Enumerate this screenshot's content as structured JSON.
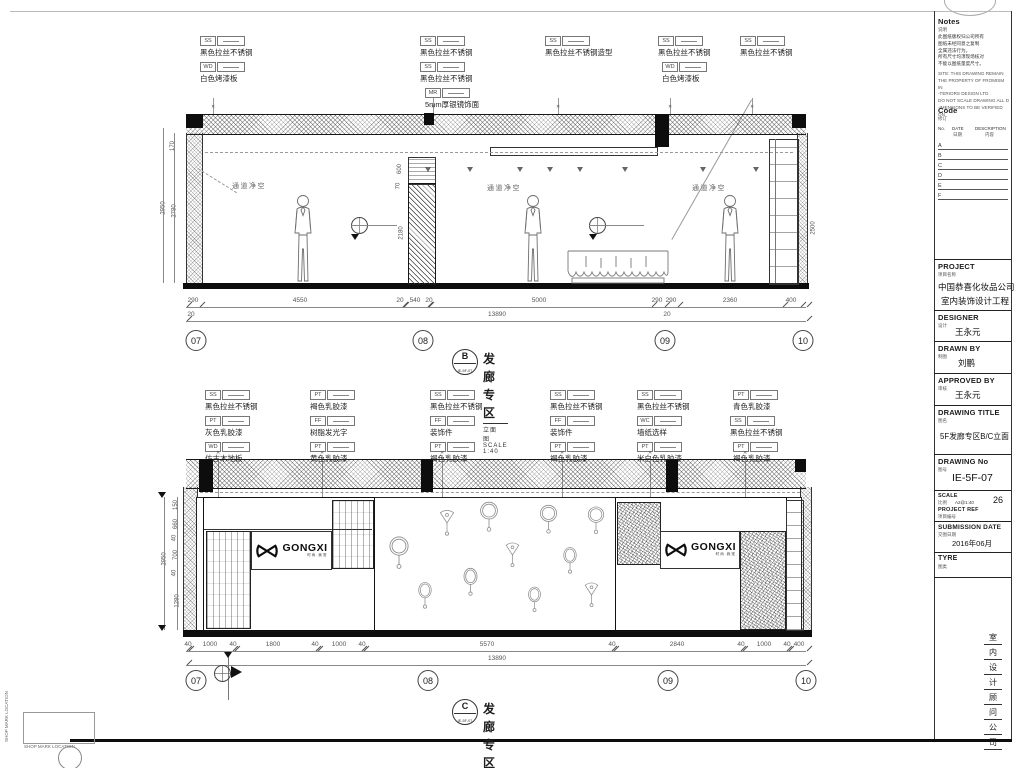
{
  "colors": {
    "ink": "#1c1c1c",
    "dim_gray": "#555555",
    "paper": "#ffffff",
    "hatch": "#3a3a3a"
  },
  "corner": {
    "shop_mark": "SHOP MARK LOCATION"
  },
  "titles": {
    "b": {
      "letter": "B",
      "ref": "IE-5F-07",
      "name": "发廊专区",
      "plan": "立面图",
      "scale": "SCALE 1:40"
    },
    "c": {
      "letter": "C",
      "ref": "IE-5F-07",
      "name": "发廊专区",
      "plan": "立面图",
      "scale": "SCALE 1:40"
    }
  },
  "logo": {
    "text": "GONGXI",
    "tagline": "时尚.我宠"
  },
  "elev_b": {
    "clearance": "通道净空",
    "tags": [
      {
        "x": 200,
        "y": 36,
        "code": "SS",
        "label": "黑色拉丝不锈钢"
      },
      {
        "x": 200,
        "y": 62,
        "code": "WD",
        "label": "白色烤漆板"
      },
      {
        "x": 420,
        "y": 36,
        "code": "SS",
        "label": "黑色拉丝不锈钢"
      },
      {
        "x": 420,
        "y": 62,
        "code": "SS",
        "label": "黑色拉丝不锈钢"
      },
      {
        "x": 425,
        "y": 88,
        "code": "MR",
        "label": "5mm厚银镜饰面"
      },
      {
        "x": 545,
        "y": 36,
        "code": "SS",
        "label": "黑色拉丝不锈钢造型"
      },
      {
        "x": 658,
        "y": 36,
        "code": "SS",
        "label": "黑色拉丝不锈钢"
      },
      {
        "x": 662,
        "y": 62,
        "code": "WD",
        "label": "白色烤漆板"
      },
      {
        "x": 740,
        "y": 36,
        "code": "SS",
        "label": "黑色拉丝不锈钢"
      }
    ],
    "leaders": [
      {
        "x": 213
      },
      {
        "x": 433
      },
      {
        "x": 558
      },
      {
        "x": 670
      },
      {
        "x": 752
      }
    ],
    "lights": [
      {
        "x": 425
      },
      {
        "x": 467
      },
      {
        "x": 517
      },
      {
        "x": 547
      },
      {
        "x": 577
      },
      {
        "x": 622
      },
      {
        "x": 700
      },
      {
        "x": 753
      }
    ],
    "clearances": [
      {
        "x": 232,
        "y": 181
      },
      {
        "x": 487,
        "y": 183
      },
      {
        "x": 692,
        "y": 183
      }
    ],
    "levels": [
      {
        "x": 351,
        "lw": 46
      },
      {
        "x": 589,
        "lw": 55
      }
    ],
    "humans": [
      {
        "x": 286
      },
      {
        "x": 516
      },
      {
        "x": 713
      }
    ],
    "dims1": [
      {
        "v": "290",
        "cx": 193
      },
      {
        "v": "4550",
        "cx": 300
      },
      {
        "v": "20",
        "cx": 400
      },
      {
        "v": "540",
        "cx": 415
      },
      {
        "v": "20",
        "cx": 429
      },
      {
        "v": "5000",
        "cx": 539
      },
      {
        "v": "290",
        "cx": 657
      },
      {
        "v": "290",
        "cx": 671
      },
      {
        "v": "2360",
        "cx": 730
      },
      {
        "v": "400",
        "cx": 791
      }
    ],
    "ticks1": [
      {
        "x": 186
      },
      {
        "x": 199
      },
      {
        "x": 402
      },
      {
        "x": 403
      },
      {
        "x": 427
      },
      {
        "x": 428
      },
      {
        "x": 651
      },
      {
        "x": 664
      },
      {
        "x": 677
      },
      {
        "x": 782
      },
      {
        "x": 800
      },
      {
        "x": 806
      }
    ],
    "dims2": [
      {
        "v": "20",
        "cx": 191
      },
      {
        "v": "13890",
        "cx": 497
      },
      {
        "v": "20",
        "cx": 667
      }
    ],
    "ticks2": [
      {
        "x": 186
      },
      {
        "x": 806
      }
    ],
    "vdims": [
      {
        "v": "2950",
        "x": 157,
        "y": 205
      },
      {
        "v": "2780",
        "x": 168,
        "y": 208
      },
      {
        "v": "170",
        "x": 168,
        "y": 143
      },
      {
        "v": "600",
        "x": 395,
        "y": 166
      },
      {
        "v": "70",
        "x": 395,
        "y": 183
      },
      {
        "v": "2180",
        "x": 395,
        "y": 230
      },
      {
        "v": "2500",
        "x": 807,
        "y": 225
      }
    ],
    "grid": [
      {
        "v": "07",
        "x": 196
      },
      {
        "v": "08",
        "x": 423
      },
      {
        "v": "09",
        "x": 665
      },
      {
        "v": "10",
        "x": 803
      }
    ]
  },
  "elev_c": {
    "tags": [
      {
        "x": 205,
        "y": 390,
        "code": "SS",
        "label": "黑色拉丝不锈钢"
      },
      {
        "x": 205,
        "y": 416,
        "code": "PT",
        "label": "灰色乳胶漆"
      },
      {
        "x": 205,
        "y": 442,
        "code": "WD",
        "label": "仿古木地板"
      },
      {
        "x": 310,
        "y": 390,
        "code": "PT",
        "label": "褐色乳胶漆"
      },
      {
        "x": 310,
        "y": 416,
        "code": "FF",
        "label": "树脂发光字"
      },
      {
        "x": 310,
        "y": 442,
        "code": "PT",
        "label": "黄色乳胶漆"
      },
      {
        "x": 430,
        "y": 390,
        "code": "SS",
        "label": "黑色拉丝不锈钢"
      },
      {
        "x": 430,
        "y": 416,
        "code": "FF",
        "label": "装饰件"
      },
      {
        "x": 430,
        "y": 442,
        "code": "PT",
        "label": "褐色乳胶漆"
      },
      {
        "x": 550,
        "y": 390,
        "code": "SS",
        "label": "黑色拉丝不锈钢"
      },
      {
        "x": 550,
        "y": 416,
        "code": "FF",
        "label": "装饰件"
      },
      {
        "x": 550,
        "y": 442,
        "code": "PT",
        "label": "褐色乳胶漆"
      },
      {
        "x": 637,
        "y": 390,
        "code": "SS",
        "label": "黑色拉丝不锈钢"
      },
      {
        "x": 637,
        "y": 416,
        "code": "WC",
        "label": "墙纸选样"
      },
      {
        "x": 637,
        "y": 442,
        "code": "PT",
        "label": "米白色乳胶漆"
      },
      {
        "x": 733,
        "y": 390,
        "code": "PT",
        "label": "青色乳胶漆"
      },
      {
        "x": 730,
        "y": 416,
        "code": "SS",
        "label": "黑色拉丝不锈钢"
      },
      {
        "x": 733,
        "y": 442,
        "code": "PT",
        "label": "褐色乳胶漆"
      }
    ],
    "leaders": [
      {
        "x": 218,
        "h": 64
      },
      {
        "x": 322,
        "h": 100
      },
      {
        "x": 442,
        "h": 165
      },
      {
        "x": 562,
        "h": 64
      },
      {
        "x": 650,
        "h": 106
      },
      {
        "x": 745,
        "h": 172
      }
    ],
    "mirrors": [
      {
        "x": 386,
        "y": 535,
        "w": 26,
        "h": 36,
        "icon": "#mir-round"
      },
      {
        "x": 414,
        "y": 580,
        "w": 22,
        "h": 32,
        "icon": "#mir-oval"
      },
      {
        "x": 436,
        "y": 508,
        "w": 22,
        "h": 30,
        "icon": "#mir-fan"
      },
      {
        "x": 459,
        "y": 566,
        "w": 23,
        "h": 33,
        "icon": "#mir-oval"
      },
      {
        "x": 477,
        "y": 500,
        "w": 24,
        "h": 34,
        "icon": "#mir-round"
      },
      {
        "x": 502,
        "y": 540,
        "w": 21,
        "h": 30,
        "icon": "#mir-fan"
      },
      {
        "x": 524,
        "y": 585,
        "w": 21,
        "h": 30,
        "icon": "#mir-oval"
      },
      {
        "x": 537,
        "y": 503,
        "w": 23,
        "h": 33,
        "icon": "#mir-round"
      },
      {
        "x": 559,
        "y": 545,
        "w": 22,
        "h": 32,
        "icon": "#mir-oval"
      },
      {
        "x": 581,
        "y": 580,
        "w": 21,
        "h": 30,
        "icon": "#mir-fan"
      },
      {
        "x": 585,
        "y": 505,
        "w": 22,
        "h": 31,
        "icon": "#mir-round"
      }
    ],
    "dims1": [
      {
        "v": "40",
        "cx": 188
      },
      {
        "v": "1000",
        "cx": 210
      },
      {
        "v": "40",
        "cx": 233
      },
      {
        "v": "1800",
        "cx": 273
      },
      {
        "v": "40",
        "cx": 315
      },
      {
        "v": "1000",
        "cx": 339
      },
      {
        "v": "40",
        "cx": 362
      },
      {
        "v": "5570",
        "cx": 487
      },
      {
        "v": "40",
        "cx": 612
      },
      {
        "v": "2840",
        "cx": 677
      },
      {
        "v": "40",
        "cx": 741
      },
      {
        "v": "1000",
        "cx": 764
      },
      {
        "v": "40",
        "cx": 787
      },
      {
        "v": "400",
        "cx": 799
      }
    ],
    "ticks1": [
      {
        "x": 186
      },
      {
        "x": 188
      },
      {
        "x": 232
      },
      {
        "x": 234
      },
      {
        "x": 315
      },
      {
        "x": 317
      },
      {
        "x": 361
      },
      {
        "x": 363
      },
      {
        "x": 611
      },
      {
        "x": 613
      },
      {
        "x": 740
      },
      {
        "x": 742
      },
      {
        "x": 786
      },
      {
        "x": 788
      },
      {
        "x": 806
      }
    ],
    "dims2": [
      {
        "v": "13890",
        "cx": 497
      }
    ],
    "ticks2": [
      {
        "x": 186
      },
      {
        "x": 806
      }
    ],
    "vdims": [
      {
        "v": "2950",
        "x": 158,
        "y": 556
      },
      {
        "v": "150",
        "x": 171,
        "y": 502
      },
      {
        "v": "660",
        "x": 171,
        "y": 521
      },
      {
        "v": "40",
        "x": 171,
        "y": 535
      },
      {
        "v": "700",
        "x": 171,
        "y": 552
      },
      {
        "v": "40",
        "x": 171,
        "y": 570
      },
      {
        "v": "1280",
        "x": 171,
        "y": 598
      }
    ],
    "grid": [
      {
        "v": "07",
        "x": 196
      },
      {
        "v": "08",
        "x": 428
      },
      {
        "v": "09",
        "x": 668
      },
      {
        "v": "10",
        "x": 806
      }
    ]
  },
  "titleblock": {
    "notes": {
      "label": "Notes",
      "sub": "说明",
      "zh_lines": [
        "此图纸版权归公司所有",
        "图纸未经同意之复制",
        "全属违法行为。",
        "所有尺寸均须现场核对",
        "不能以图纸量度尺寸。"
      ],
      "en_lines": [
        "SITE: THIS DRAWING REMAIN",
        "THE PROPERTY OF FROMISM IN",
        "-TERIORS DESIGN LTD",
        "DO NOT SCALE DRAWING ALL D",
        "-IMENSIONS TO BE VERIFIED ON"
      ]
    },
    "code": {
      "label": "Code",
      "sub": "修订",
      "col_no": "No.",
      "col_date": "DATE",
      "col_date_zh": "日期",
      "col_desc": "DESCRIPTION",
      "col_desc_zh": "内容",
      "rows": [
        "A",
        "B",
        "C",
        "D",
        "E",
        "F"
      ]
    },
    "project": {
      "label": "PROJECT",
      "sub": "项目名称",
      "line1": "中国恭喜化妆品公司",
      "line2": "室内装饰设计工程"
    },
    "designer": {
      "label": "DESIGNER",
      "sub": "设计",
      "value": "王永元"
    },
    "drawn_by": {
      "label": "DRAWN BY",
      "sub": "制图",
      "value": "刘鹏"
    },
    "approved_by": {
      "label": "APPROVED BY",
      "sub": "审核",
      "value": "王永元"
    },
    "drawing_title": {
      "label": "DRAWING TITLE",
      "sub": "图名",
      "value": "5F发廊专区B/C立面"
    },
    "drawing_no": {
      "label": "DRAWING No",
      "sub": "图号",
      "value": "IE-5F-07"
    },
    "scale": {
      "label": "SCALE",
      "sub": "比例",
      "value": "A2@1:40",
      "sheet_no": "26"
    },
    "project_ref": {
      "label": "PROJECT REF",
      "sub": "项目编号"
    },
    "submission": {
      "label": "SUBMISSION DATE",
      "sub": "交图日期",
      "value": "2016年06月"
    },
    "type": {
      "label": "TYRE",
      "sub": "图类"
    },
    "company_vertical": [
      "室",
      "内",
      "设",
      "计",
      "顾",
      "问",
      "公",
      "司"
    ]
  }
}
